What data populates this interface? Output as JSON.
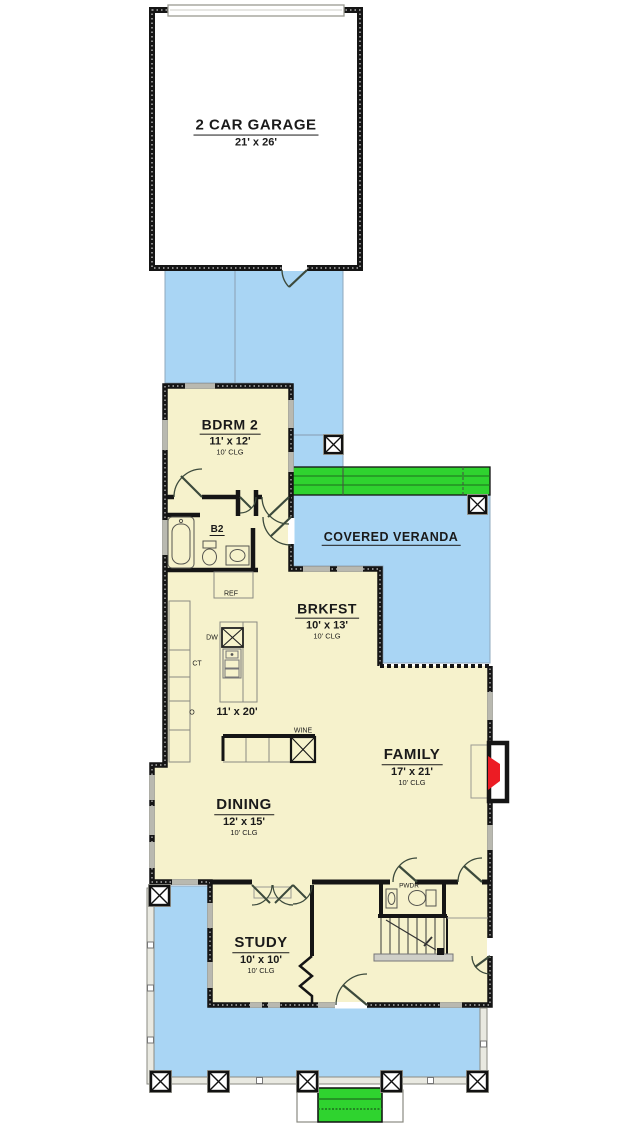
{
  "rooms": {
    "garage": {
      "name": "2 CAR GARAGE",
      "dims": "21' x 26'"
    },
    "bdrm2": {
      "name": "BDRM 2",
      "dims": "11' x 12'",
      "clg": "10' CLG"
    },
    "veranda": {
      "name": "COVERED VERANDA"
    },
    "brkfst": {
      "name": "BRKFST",
      "dims": "10' x 13'",
      "clg": "10' CLG"
    },
    "kitchen": {
      "dims": "11' x 20'"
    },
    "family": {
      "name": "FAMILY",
      "dims": "17' x 21'",
      "clg": "10' CLG"
    },
    "dining": {
      "name": "DINING",
      "dims": "12' x 15'",
      "clg": "10' CLG"
    },
    "study": {
      "name": "STUDY",
      "dims": "10' x 10'",
      "clg": "10' CLG"
    },
    "bath2": {
      "name": "B2"
    },
    "powder": {
      "name": "PWDR"
    }
  },
  "fixtures": {
    "ref": "REF",
    "dw": "DW",
    "ct": "CT",
    "oven": "O",
    "wine": "WINE"
  },
  "colors": {
    "outdoor_blue": "#A9D5F4",
    "steps_green": "#2FD32F",
    "fireplace_red": "#EC1C24",
    "floor_cream": "#F6F2CC",
    "wall_black": "#151515",
    "window_gray": "#B9B9B0"
  }
}
